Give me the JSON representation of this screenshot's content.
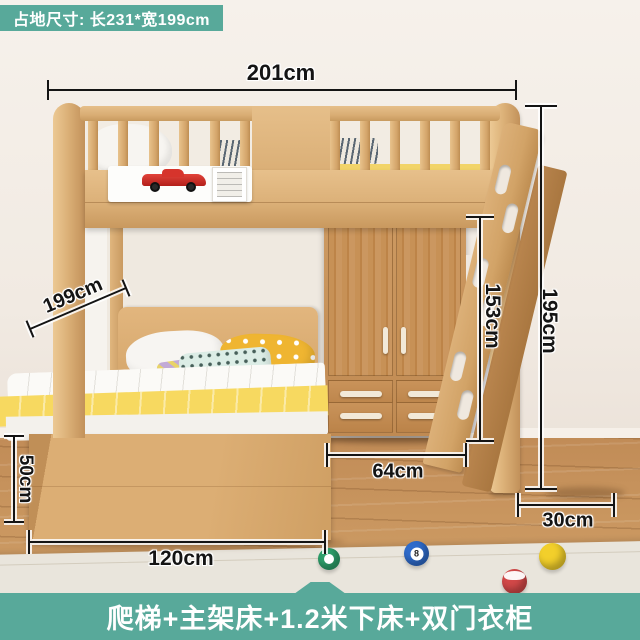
{
  "badge": {
    "text": "占地尺寸: 长231*宽199cm"
  },
  "banner": {
    "text": "爬梯+主架床+1.2米下床+双门衣柜"
  },
  "dimensions": {
    "top_width": "201cm",
    "overall_height": "195cm",
    "wardrobe_height": "153cm",
    "bed_length": "199cm",
    "bed_box_height": "50cm",
    "wardrobe_width": "64cm",
    "lower_bed_width": "120cm",
    "ladder_clearance": "30cm"
  },
  "toys": {
    "eight_ball_label": "8"
  },
  "colors": {
    "accent_teal": "#58a99a",
    "wood_light": "#ddb17c",
    "wood_medium": "#c08a52",
    "blanket_yellow": "#f8da63",
    "floor_wood": "#c9965f",
    "dimension_text": "#141414"
  }
}
